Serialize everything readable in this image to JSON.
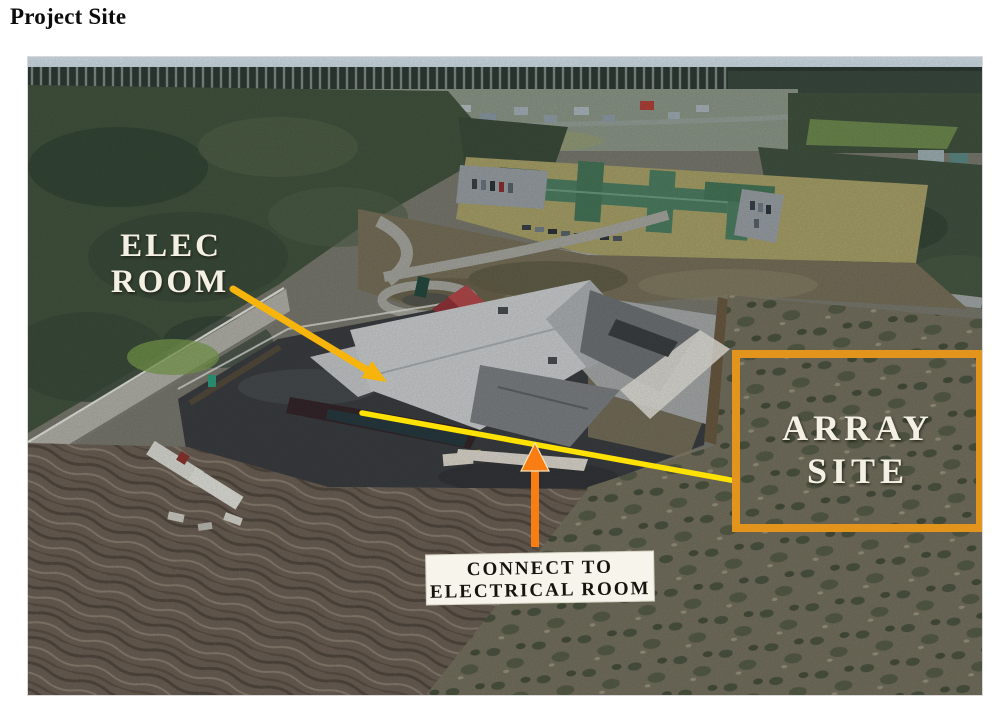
{
  "page": {
    "title": "Project Site"
  },
  "photo": {
    "alt": "Aerial drone photograph of the project site: a building under construction on a dark gravel pad, forest and a green-roofed school campus behind it, cleared muddy ground in the foreground and scrubland at right",
    "annotations": {
      "elec_room": {
        "line1": "ELEC",
        "line2": "ROOM"
      },
      "array_site": {
        "line1": "ARRAY",
        "line2": "SITE"
      },
      "connect_note": {
        "line1": "CONNECT TO",
        "line2": "ELECTRICAL ROOM"
      }
    },
    "colors": {
      "annotation_yellow": "#FFE104",
      "arrow_gold": "#F7B50C",
      "arrow_orange": "#F87E14",
      "array_box_orange": "#E2941C",
      "label_background": "#F7F4EB",
      "label_text": "#17140E",
      "overlay_text": "#F4F0E3"
    }
  }
}
